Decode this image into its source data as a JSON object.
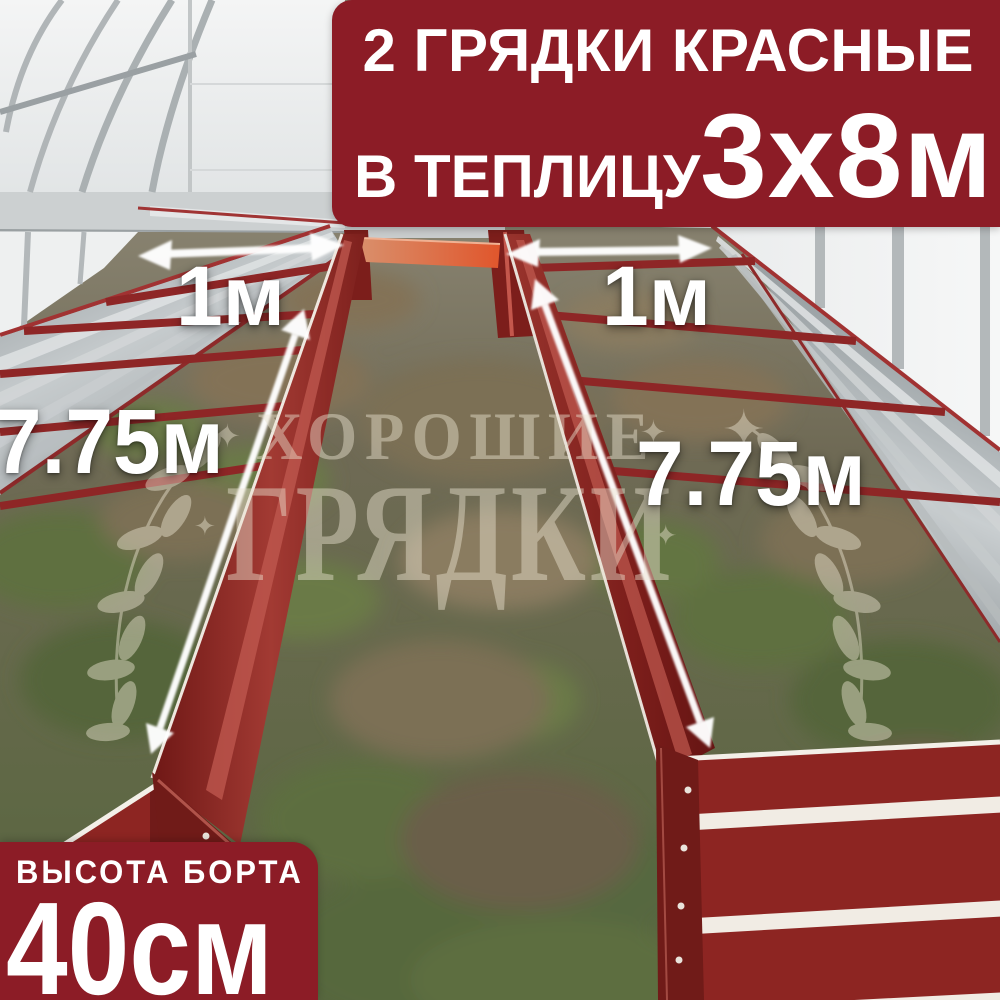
{
  "top_banner": {
    "line1": "2 ГРЯДКИ КРАСНЫЕ",
    "line2_label": "В ТЕПЛИЦУ",
    "line2_value": "3х8м"
  },
  "bottom_banner": {
    "label": "ВЫСОТА БОРТА",
    "value": "40см"
  },
  "measurements": {
    "left_bed_width": "1м",
    "right_bed_width": "1м",
    "left_bed_length": "7.75м",
    "right_bed_length": "7.75м"
  },
  "watermark": {
    "line1": "ХОРОШИЕ",
    "line2": "ГРЯДКИ",
    "star": "✦"
  },
  "colors": {
    "banner_red": "#8c1c26",
    "bed_red": "#8d2522",
    "bed_red_dark": "#701b18",
    "galvanized": "#b5babc",
    "orange_connector": "#dd5b2e",
    "arrow_white": "#ffffff",
    "text_white": "#ffffff"
  }
}
